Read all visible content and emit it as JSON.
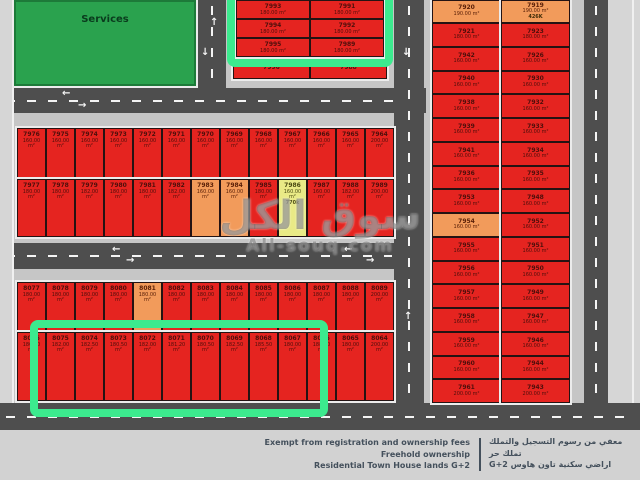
{
  "services_label": "Services",
  "watermark": {
    "arabic": "سوق الكل",
    "latin": "All-souq.com"
  },
  "legend": {
    "en": [
      "Exempt from registration and ownership fees",
      "Freehold ownership",
      "Residential Town House lands G+2"
    ],
    "ar": [
      "معفي من رسوم التسجيل والتملك",
      "تملك حر",
      "اراضي سكنية تاون هاوس G+2"
    ]
  },
  "colors": {
    "plot_red": "#e52420",
    "plot_orange": "#f29b5b",
    "plot_yellow": "#e9ea86",
    "highlight_green": "#3cea8e",
    "services_green": "#2aa24e",
    "road_gray": "#4e4e4e"
  },
  "blocks": {
    "top": {
      "main": [
        {
          "n": "7993",
          "a": "180.00 m²"
        },
        {
          "n": "7991",
          "a": "180.00 m²"
        },
        {
          "n": "7994",
          "a": "180.00 m²"
        },
        {
          "n": "7992",
          "a": "180.00 m²"
        },
        {
          "n": "7995",
          "a": "180.00 m²"
        },
        {
          "n": "7989",
          "a": "180.00 m²"
        }
      ],
      "extra": [
        {
          "n": "7996"
        },
        {
          "n": "7988"
        }
      ]
    },
    "middle": {
      "row1": [
        {
          "n": "7976",
          "a": "160.00 m²"
        },
        {
          "n": "7975",
          "a": "160.00 m²"
        },
        {
          "n": "7974",
          "a": "160.00 m²"
        },
        {
          "n": "7973",
          "a": "160.00 m²"
        },
        {
          "n": "7972",
          "a": "160.00 m²"
        },
        {
          "n": "7971",
          "a": "160.00 m²"
        },
        {
          "n": "7970",
          "a": "160.00 m²"
        },
        {
          "n": "7969",
          "a": "160.00 m²"
        },
        {
          "n": "7968",
          "a": "160.00 m²"
        },
        {
          "n": "7967",
          "a": "160.00 m²"
        },
        {
          "n": "7966",
          "a": "160.00 m²"
        },
        {
          "n": "7965",
          "a": "160.00 m²"
        },
        {
          "n": "7964",
          "a": "200.00 m²"
        }
      ],
      "row2": [
        {
          "n": "7977",
          "a": "180.00 m²"
        },
        {
          "n": "7978",
          "a": "180.00 m²"
        },
        {
          "n": "7979",
          "a": "182.00 m²"
        },
        {
          "n": "7980",
          "a": "180.00 m²"
        },
        {
          "n": "7981",
          "a": "180.00 m²"
        },
        {
          "n": "7982",
          "a": "182.00 m²"
        },
        {
          "n": "7983",
          "a": "160.00 m²",
          "c": "orange"
        },
        {
          "n": "7984",
          "a": "160.00 m²",
          "c": "orange"
        },
        {
          "n": "7985",
          "a": "180.00 m²"
        },
        {
          "n": "7986",
          "a": "160.00 m²",
          "c": "yellow",
          "t": "770k"
        },
        {
          "n": "7987",
          "a": "160.00 m²"
        },
        {
          "n": "7988",
          "a": "182.00 m²"
        },
        {
          "n": "7989",
          "a": "200.00 m²"
        }
      ]
    },
    "bottom": {
      "row1": [
        {
          "n": "8077",
          "a": "180.00 m²"
        },
        {
          "n": "8078",
          "a": "180.00 m²"
        },
        {
          "n": "8079",
          "a": "180.00 m²"
        },
        {
          "n": "8080",
          "a": "180.00 m²"
        },
        {
          "n": "8081",
          "a": "180.00 m²",
          "c": "orange"
        },
        {
          "n": "8082",
          "a": "180.00 m²"
        },
        {
          "n": "8083",
          "a": "180.00 m²"
        },
        {
          "n": "8084",
          "a": "180.00 m²"
        },
        {
          "n": "8085",
          "a": "180.00 m²"
        },
        {
          "n": "8086",
          "a": "180.00 m²"
        },
        {
          "n": "8087",
          "a": "180.00 m²"
        },
        {
          "n": "8088",
          "a": "180.00 m²"
        },
        {
          "n": "8089",
          "a": "200.00 m²"
        }
      ],
      "row2": [
        {
          "n": "8076",
          "a": "180.00 m²"
        },
        {
          "n": "8075",
          "a": "182.00 m²"
        },
        {
          "n": "8074",
          "a": "182.50 m²"
        },
        {
          "n": "8073",
          "a": "180.50 m²"
        },
        {
          "n": "8072",
          "a": "182.00 m²"
        },
        {
          "n": "8071",
          "a": "181.20 m²"
        },
        {
          "n": "8070",
          "a": "180.50 m²"
        },
        {
          "n": "8069",
          "a": "182.50 m²"
        },
        {
          "n": "8068",
          "a": "185.50 m²"
        },
        {
          "n": "8067",
          "a": "180.00 m²"
        },
        {
          "n": "8066",
          "a": "188.50 m²"
        },
        {
          "n": "8065",
          "a": "180.00 m²"
        },
        {
          "n": "8064",
          "a": "200.00 m²"
        }
      ]
    },
    "right": {
      "col1": [
        {
          "n": "7920",
          "a": "190.00 m²",
          "c": "orange"
        },
        {
          "n": "7921",
          "a": "180.00 m²"
        },
        {
          "n": "7942",
          "a": "160.00 m²"
        },
        {
          "n": "7940",
          "a": "160.00 m²"
        },
        {
          "n": "7938",
          "a": "160.00 m²"
        },
        {
          "n": "7939",
          "a": "160.00 m²"
        },
        {
          "n": "7941",
          "a": "160.00 m²"
        },
        {
          "n": "7936",
          "a": "160.00 m²"
        },
        {
          "n": "7953",
          "a": "160.00 m²"
        },
        {
          "n": "7954",
          "a": "160.00 m²",
          "c": "orange"
        },
        {
          "n": "7955",
          "a": "160.00 m²"
        },
        {
          "n": "7956",
          "a": "160.00 m²"
        },
        {
          "n": "7957",
          "a": "160.00 m²"
        },
        {
          "n": "7958",
          "a": "160.00 m²"
        },
        {
          "n": "7959",
          "a": "160.00 m²"
        },
        {
          "n": "7960",
          "a": "160.00 m²"
        },
        {
          "n": "7961",
          "a": "200.00 m²"
        }
      ],
      "col2": [
        {
          "n": "7919",
          "a": "190.00 m²",
          "c": "orange",
          "t": "426K"
        },
        {
          "n": "7923",
          "a": "180.00 m²"
        },
        {
          "n": "7926",
          "a": "160.00 m²"
        },
        {
          "n": "7930",
          "a": "160.00 m²"
        },
        {
          "n": "7932",
          "a": "160.00 m²"
        },
        {
          "n": "7933",
          "a": "160.00 m²"
        },
        {
          "n": "7934",
          "a": "160.00 m²"
        },
        {
          "n": "7935",
          "a": "160.00 m²"
        },
        {
          "n": "7948",
          "a": "160.00 m²"
        },
        {
          "n": "7952",
          "a": "160.00 m²"
        },
        {
          "n": "7951",
          "a": "160.00 m²"
        },
        {
          "n": "7950",
          "a": "160.00 m²"
        },
        {
          "n": "7949",
          "a": "160.00 m²"
        },
        {
          "n": "7947",
          "a": "160.00 m²"
        },
        {
          "n": "7946",
          "a": "160.00 m²"
        },
        {
          "n": "7944",
          "a": "160.00 m²"
        },
        {
          "n": "7943",
          "a": "200.00 m²"
        }
      ]
    }
  }
}
